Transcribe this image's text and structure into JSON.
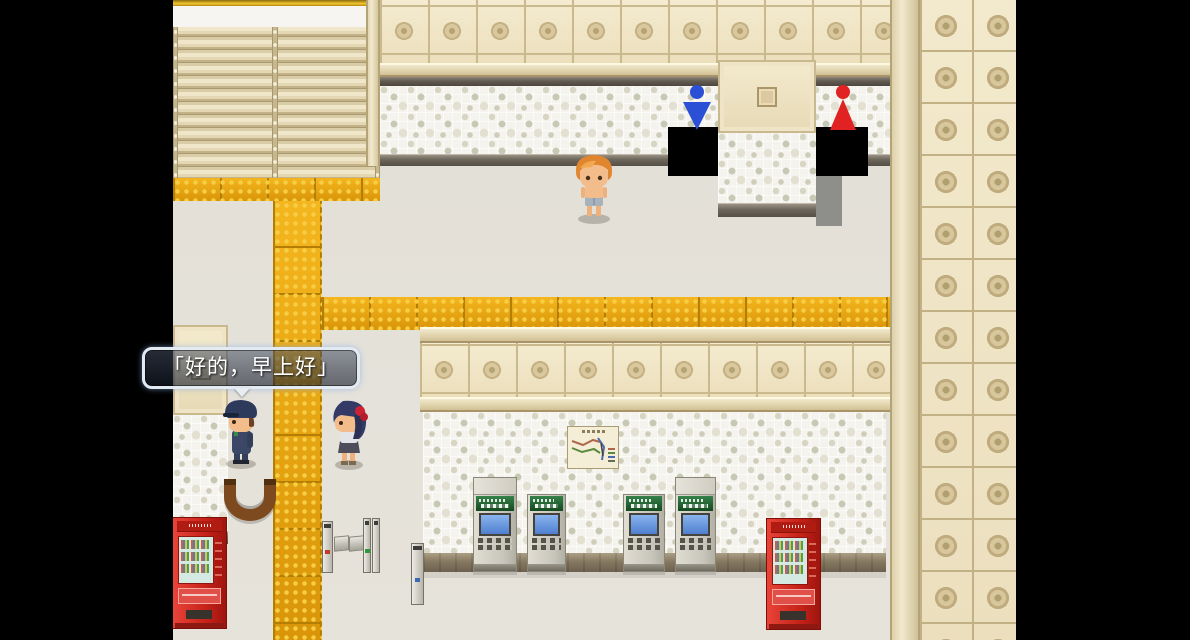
{
  "scene": {
    "name": "station-interior",
    "letterbox_color": "#000000",
    "floor_color": "#e3e0d8",
    "wall_cream_color": "#f1e7ca",
    "mosaic_base_color": "#f4f3ed",
    "tactile_paving_color": "#eaa90f",
    "doorway_color": "#000000"
  },
  "dialogue": {
    "text": "「好的，早上好」",
    "text_color": "#ffffff",
    "border_color": "#e4eaf2"
  },
  "icons": {
    "male_restroom": {
      "name": "male-restroom-icon",
      "color": "#2b50d6"
    },
    "female_restroom": {
      "name": "female-restroom-icon",
      "color": "#e02222"
    }
  },
  "characters": {
    "player": {
      "description": "orange-haired character facing down",
      "hair_color": "#e0862e",
      "skin_color": "#f2bd8a",
      "shorts_color": "#a8b2bc"
    },
    "attendant": {
      "description": "station attendant in navy uniform with cap",
      "uniform_color": "#3a4766",
      "cap_color": "#2e3a5c"
    },
    "girl": {
      "description": "girl with dark blue hair and red ribbon",
      "hair_color": "#333a66",
      "ribbon_color": "#cc2233",
      "top_color": "#e3e4e8"
    }
  },
  "objects": {
    "ticket_machines": {
      "count": 4,
      "header_color": "#1f6b33",
      "screen_color": "#6aa0e8",
      "body_color": "#cfccc1"
    },
    "vending_machines": {
      "count": 2,
      "color": "#d42a20"
    },
    "route_map": {
      "background": "#f4eed6",
      "line_colors": [
        "#b0674a",
        "#5a8a3a",
        "#4a6ab4"
      ]
    },
    "ticket_gates": {
      "post_color": "#c9c6bd",
      "indicator_colors": [
        "#c03a2a",
        "#2a9a3a"
      ]
    },
    "bench_arc": {
      "color": "#7c4a1e"
    }
  }
}
